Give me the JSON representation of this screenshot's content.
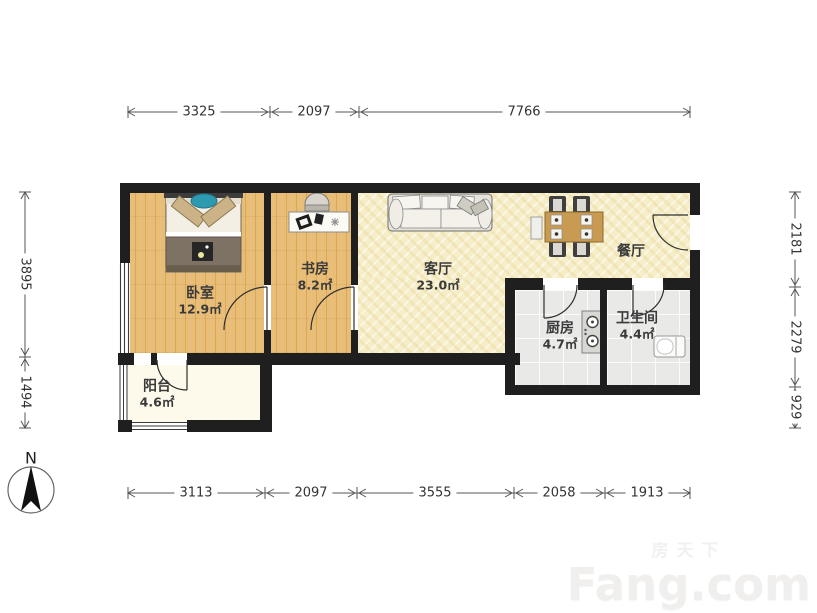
{
  "plan": {
    "title": "apartment-floor-plan",
    "rooms": [
      {
        "id": "bedroom",
        "name": "卧室",
        "area": "12.9㎡"
      },
      {
        "id": "study",
        "name": "书房",
        "area": "8.2㎡"
      },
      {
        "id": "living",
        "name": "客厅",
        "area": "23.0㎡"
      },
      {
        "id": "dining",
        "name": "餐厅",
        "area": ""
      },
      {
        "id": "kitchen",
        "name": "厨房",
        "area": "4.7㎡"
      },
      {
        "id": "bathroom",
        "name": "卫生间",
        "area": "4.4㎡"
      },
      {
        "id": "balcony",
        "name": "阳台",
        "area": "4.6㎡"
      }
    ],
    "dimensions": {
      "top": [
        "3325",
        "2097",
        "7766"
      ],
      "bottom": [
        "3113",
        "2097",
        "3555",
        "2058",
        "1913"
      ],
      "left": [
        "3895",
        "1494"
      ],
      "right": [
        "2181",
        "2279",
        "929"
      ]
    },
    "compass": {
      "label": "N"
    },
    "watermark": {
      "cn": "房天下",
      "brand": "Fang.com"
    },
    "colors": {
      "wall": "#1f1f1f",
      "wood_floor": "#eabd74",
      "living_floor": "#f6eec8",
      "tile_floor": "#e9eae8",
      "balcony_floor": "#fdfaeb",
      "accent_pillow_teal": "#2e9ab0",
      "dining_table_wood": "#c89a52"
    }
  }
}
